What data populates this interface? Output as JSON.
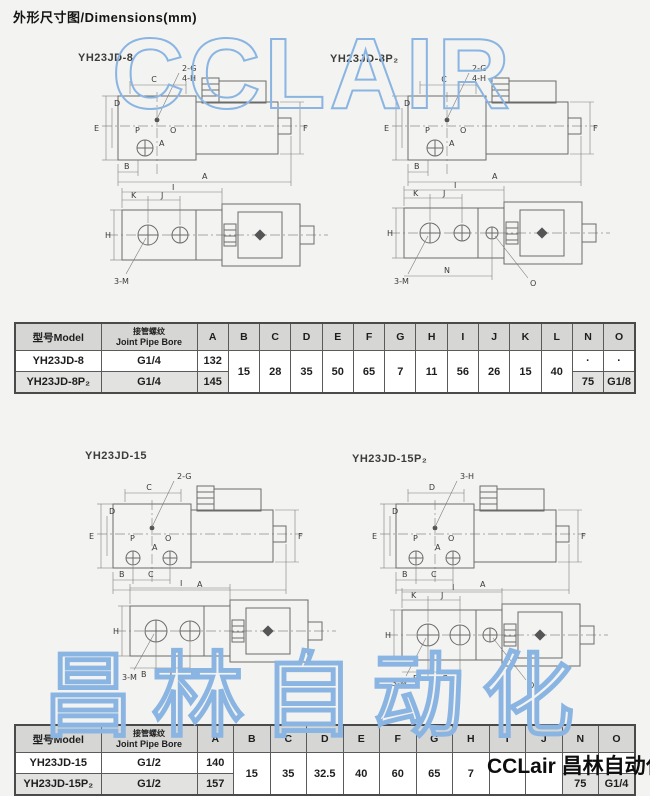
{
  "page": {
    "title": "外形尺寸图/Dimensions(mm)"
  },
  "watermarks": {
    "top": "CCLAIR",
    "bottom": "昌林自动化",
    "brand": "CCLair 昌林自动化",
    "outline_color": "#8ab5e2"
  },
  "drawings": {
    "dim_letters": {
      "a": "A",
      "b": "B",
      "c": "C",
      "d": "D",
      "e": "E",
      "f": "F",
      "h": "H",
      "i": "I",
      "j": "J",
      "k": "K",
      "n": "N",
      "o": "O",
      "p": "P",
      "m": "3-M"
    },
    "s8": {
      "title": "YH23JD-8",
      "callout1": "2-G",
      "callout2": "4-H"
    },
    "s8p": {
      "title": "YH23JD-8P₂",
      "callout1": "2-G",
      "callout2": "4-H"
    },
    "s15": {
      "title": "YH23JD-15",
      "callout1": "2-G"
    },
    "s15p": {
      "title": "YH23JD-15P₂",
      "callout1": "3-H"
    }
  },
  "tables": {
    "t1": {
      "header": {
        "model": "型号Model",
        "bore_cn": "接管螺纹",
        "bore_en": "Joint Pipe Bore",
        "cols": [
          "A",
          "B",
          "C",
          "D",
          "E",
          "F",
          "G",
          "H",
          "I",
          "J",
          "K",
          "L",
          "N",
          "O"
        ]
      },
      "shared": {
        "b": "15",
        "c": "28",
        "d": "35",
        "e": "50",
        "f": "65",
        "g": "7",
        "h": "11",
        "i": "56",
        "j": "26",
        "k": "15",
        "l": "40"
      },
      "rows": [
        {
          "model": "YH23JD-8",
          "bore": "G1/4",
          "a": "132",
          "n": "·",
          "o": "·"
        },
        {
          "model": "YH23JD-8P₂",
          "bore": "G1/4",
          "a": "145",
          "n": "75",
          "o": "G1/8"
        }
      ]
    },
    "t2": {
      "header": {
        "model": "型号Model",
        "bore_cn": "接管螺纹",
        "bore_en": "Joint Pipe Bore",
        "cols": [
          "A",
          "B",
          "C",
          "D",
          "E",
          "F",
          "G",
          "H",
          "I",
          "J",
          "N",
          "O"
        ]
      },
      "shared": {
        "b": "15",
        "c": "35",
        "d": "32.5",
        "e": "40",
        "f": "60",
        "g": "65",
        "h": "7",
        "i": "",
        "j": ""
      },
      "rows": [
        {
          "model": "YH23JD-15",
          "bore": "G1/2",
          "a": "140",
          "n": "",
          "o": ""
        },
        {
          "model": "YH23JD-15P₂",
          "bore": "G1/2",
          "a": "157",
          "n": "75",
          "o": "G1/4"
        }
      ]
    }
  }
}
